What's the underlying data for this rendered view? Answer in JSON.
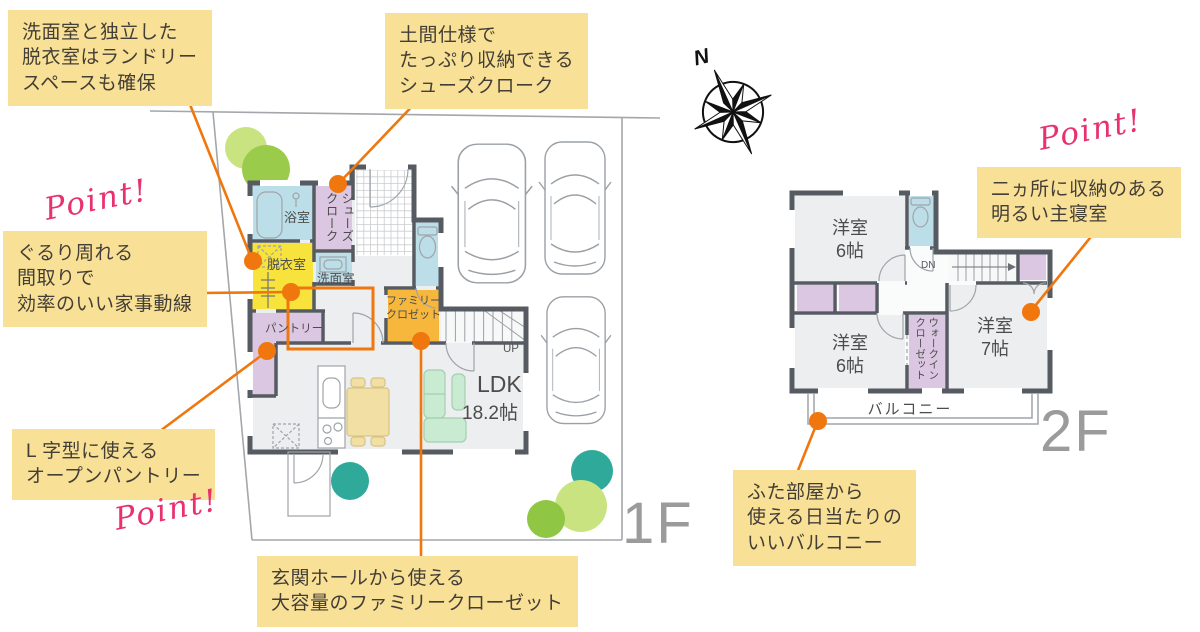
{
  "title": "住宅間取り図インフォグラフィック 1F・2F",
  "point_label": "Point!",
  "compass": {
    "north": "N"
  },
  "floors": {
    "first": "1F",
    "second": "2F"
  },
  "callouts": {
    "laundry": {
      "text": "洗面室と独立した\n脱衣室はランドリー\nスペースも確保"
    },
    "shoe_cloak": {
      "text": "土間仕様で\nたっぷり収納できる\nシューズクローク"
    },
    "circulation": {
      "text": "ぐるり周れる\n間取りで\n効率のいい家事動線"
    },
    "pantry": {
      "text": "L 字型に使える\nオープンパントリー"
    },
    "family_closet": {
      "text": "玄関ホールから使える\n大容量のファミリークローゼット"
    },
    "bedroom": {
      "text": "二ヵ所に収納のある\n明るい主寝室"
    },
    "balcony": {
      "text": "ふた部屋から\n使える日当たりの\nいいバルコニー"
    }
  },
  "rooms_1f": {
    "bath": "浴室",
    "shoe_cloak": "シューズ\nクローク",
    "dressing": "脱衣室",
    "washroom": "洗面室",
    "pantry": "パントリー",
    "family_closet": "ファミリー\nクロゼット",
    "ldk": "LDK",
    "ldk_size": "18.2帖",
    "up": "UP"
  },
  "rooms_2f": {
    "bedroom_north": "洋室\n6帖",
    "bedroom_south": "洋室\n6帖",
    "bedroom_main": "洋室\n7帖",
    "wic": "ウォークイン\nクローゼット",
    "dn": "DN",
    "balcony": "バルコニー"
  },
  "colors": {
    "accent_orange": "#F0770D",
    "callout_yellow": "#F8E096",
    "point_pink": "#E8316E",
    "wall_gray": "#565B62",
    "floor_gray": "#ECEEEF",
    "room_blue": "#BCDEE8",
    "room_yellow": "#F8E33C",
    "room_purple": "#DCC7E2",
    "room_orange": "#F6B73C",
    "sofa_green": "#C9EBD2",
    "table_tan": "#F2DFA4",
    "tree_teal": "#2FA99A",
    "tree_lime": "#C9E380",
    "tree_green": "#8FC643",
    "floor_label_gray": "#9B9B9B"
  }
}
